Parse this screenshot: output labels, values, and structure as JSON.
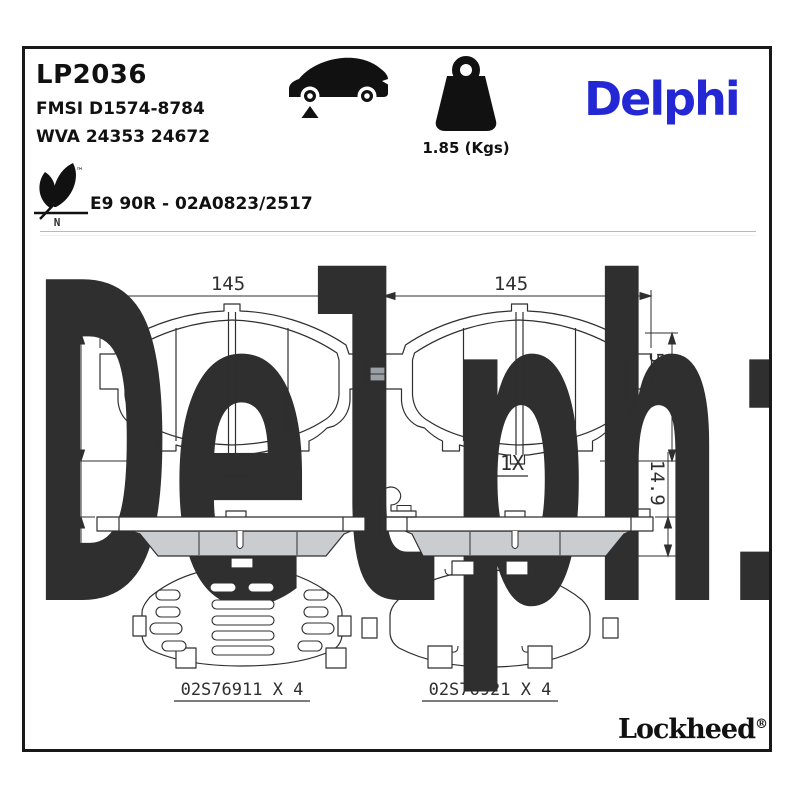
{
  "header": {
    "part_number": "LP2036",
    "fmsi": "FMSI D1574-8784",
    "wva": "WVA 24353 24672",
    "weight": "1.85 (Kgs)",
    "brand": "Delphi",
    "approval": "E9 90R - 02A0823/2517",
    "trademark": "™",
    "leaf_axis_label": "N"
  },
  "watermark": {
    "text": "Delphi"
  },
  "views": {
    "front_left": {
      "width": "145",
      "height": "58.3",
      "qty": "3X"
    },
    "front_right": {
      "width": "145",
      "height": "58.3",
      "qty": "1X"
    },
    "side_left": {
      "thickness": "14.9"
    },
    "side_right": {
      "thickness": "14.9"
    }
  },
  "accessories": {
    "left": {
      "part": "02S76911 X 4"
    },
    "right": {
      "part": "02S76921 X 4"
    }
  },
  "footer": {
    "brand": "Lockheed",
    "registered": "®"
  },
  "colors": {
    "brand_blue": "#2428d4",
    "watermark_gray": "#e8ecf0",
    "line": "#2f2f2f",
    "friction_gray": "#cacdd0",
    "wear_tab_gray": "#9aa0a5"
  }
}
